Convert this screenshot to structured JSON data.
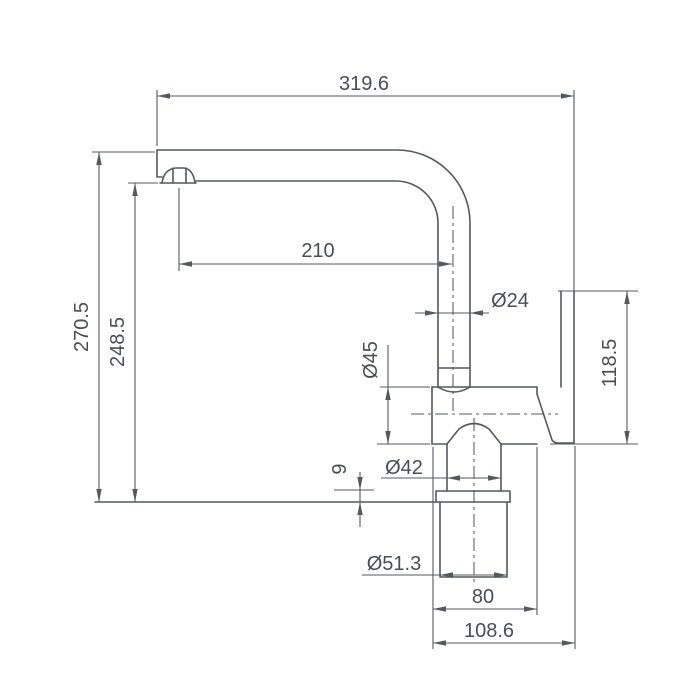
{
  "drawing": {
    "kind": "technical-dimension-drawing",
    "subject": "single-lever kitchen mixer tap, side elevation",
    "background_color": "#ffffff",
    "line_color": "#55585c",
    "text_color": "#4a4d52",
    "dimensions": {
      "spout_reach": "319.6",
      "overall_height": "270.5",
      "outlet_height": "248.5",
      "spout_projection": "210",
      "spout_tube_dia": "Ø24",
      "body_dia": "Ø45",
      "handle_height": "118.5",
      "neck_dia": "Ø42",
      "flange_thickness": "9",
      "base_dia": "Ø51.3",
      "body_length": "80",
      "overall_depth": "108.6"
    }
  }
}
